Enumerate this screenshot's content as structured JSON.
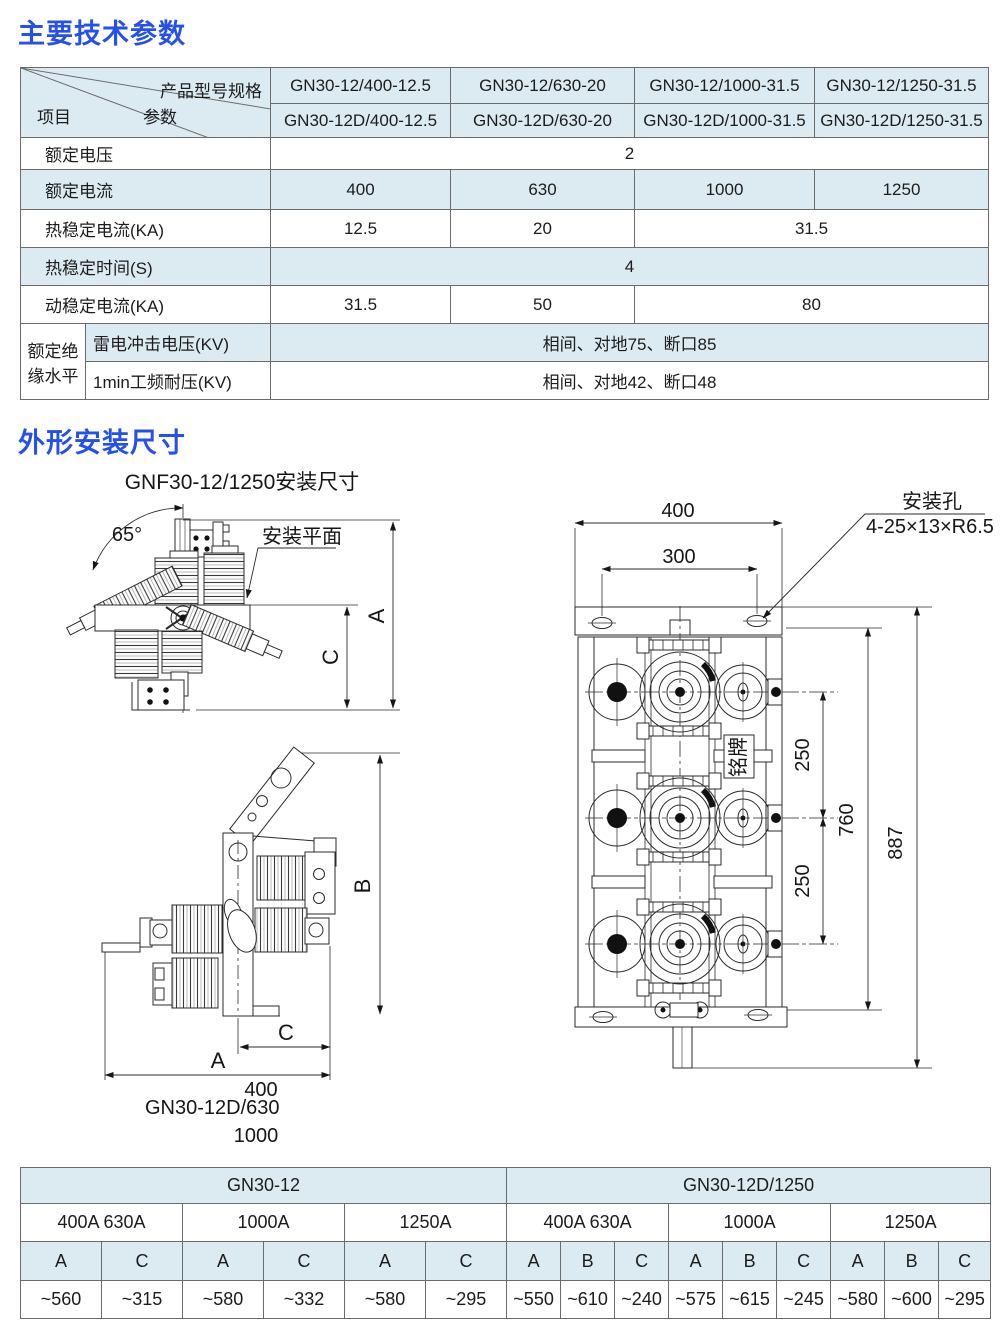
{
  "colors": {
    "accent_blue": "#2550ee",
    "cell_blue": "#dcebf2"
  },
  "titles": {
    "section1": "主要技术参数",
    "section2": "外形安装尺寸"
  },
  "spec_table": {
    "corner": {
      "top_right": "产品型号规格",
      "middle": "参数",
      "bottom_left": "项目"
    },
    "models": [
      [
        "GN30-12/400-12.5",
        "GN30-12/630-20",
        "GN30-12/1000-31.5",
        "GN30-12/1250-31.5"
      ],
      [
        "GN30-12D/400-12.5",
        "GN30-12D/630-20",
        "GN30-12D/1000-31.5",
        "GN30-12D/1250-31.5"
      ]
    ],
    "voltage": {
      "label": "额定电压",
      "value": "2"
    },
    "current": {
      "label": "额定电流",
      "values": [
        "400",
        "630",
        "1000",
        "1250"
      ]
    },
    "thermal": {
      "label": "热稳定电流(KA)",
      "values": [
        "12.5",
        "20",
        "31.5"
      ]
    },
    "time": {
      "label": "热稳定时间(S)",
      "value": "4"
    },
    "dynamic": {
      "label": "动稳定电流(KA)",
      "values": [
        "31.5",
        "50",
        "80"
      ]
    },
    "insulation": {
      "group_line1": "额定绝",
      "group_line2": "缘水平",
      "impulse": {
        "label": "雷电冲击电压(KV)",
        "value": "相间、对地75、断口85"
      },
      "pf": {
        "label": "1min工频耐压(KV)",
        "value": "相间、对地42、断口48"
      }
    }
  },
  "drawing": {
    "subtitle": "GNF30-12/1250安装尺寸",
    "angle_label": "65°",
    "mount_plane_label": "安装平面",
    "dim_a": "A",
    "dim_b": "B",
    "dim_c": "C",
    "side_width": "400",
    "side_model": "GN30-12D/630",
    "side_model2": "1000",
    "plan_width": "400",
    "plan_hole_span": "300",
    "hole_label": "安装孔",
    "hole_spec": "4-25×13×R6.5",
    "phase_pitch1": "250",
    "phase_pitch2": "250",
    "frame_height": "760",
    "total_height": "887",
    "nameplate": "铭牌"
  },
  "dim_table": {
    "left_group": "GN30-12",
    "right_group": "GN30-12D/1250",
    "left": [
      {
        "amp": "400A  630A",
        "h": [
          "A",
          "C"
        ],
        "v": [
          "~560",
          "~315"
        ]
      },
      {
        "amp": "1000A",
        "h": [
          "A",
          "C"
        ],
        "v": [
          "~580",
          "~332"
        ]
      },
      {
        "amp": "1250A",
        "h": [
          "A",
          "C"
        ],
        "v": [
          "~580",
          "~295"
        ]
      }
    ],
    "right": [
      {
        "amp": "400A  630A",
        "h": [
          "A",
          "B",
          "C"
        ],
        "v": [
          "~550",
          "~610",
          "~240"
        ]
      },
      {
        "amp": "1000A",
        "h": [
          "A",
          "B",
          "C"
        ],
        "v": [
          "~575",
          "~615",
          "~245"
        ]
      },
      {
        "amp": "1250A",
        "h": [
          "A",
          "B",
          "C"
        ],
        "v": [
          "~580",
          "~600",
          "~295"
        ]
      }
    ]
  }
}
